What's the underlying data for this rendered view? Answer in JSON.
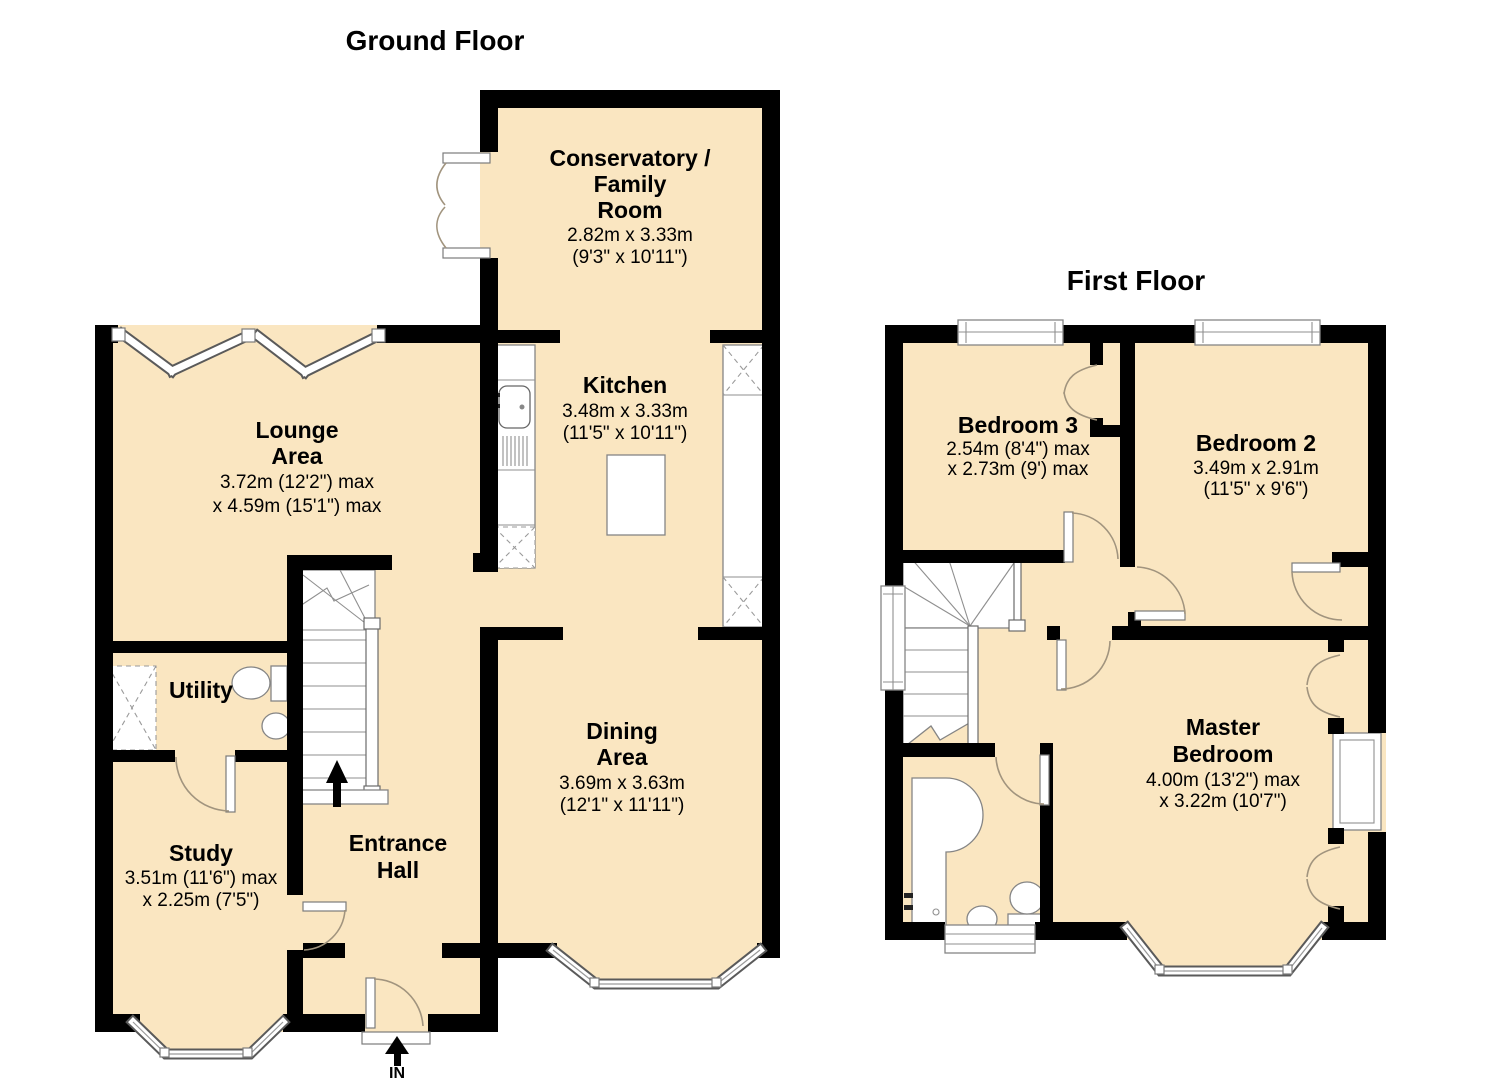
{
  "titles": {
    "ground": "Ground Floor",
    "first": "First Floor"
  },
  "entry_label": "IN",
  "ground": {
    "conservatory": {
      "lines": [
        "Conservatory /",
        "Family",
        "Room"
      ],
      "dims": [
        "2.82m x 3.33m",
        "(9'3\" x 10'11\")"
      ]
    },
    "kitchen": {
      "lines": [
        "Kitchen"
      ],
      "dims": [
        "3.48m x 3.33m",
        "(11'5\" x 10'11\")"
      ]
    },
    "lounge": {
      "lines": [
        "Lounge",
        "Area"
      ],
      "dims": [
        "3.72m (12'2\") max",
        "x 4.59m (15'1\") max"
      ]
    },
    "utility": {
      "lines": [
        "Utility"
      ],
      "dims": []
    },
    "entrance": {
      "lines": [
        "Entrance",
        "Hall"
      ],
      "dims": []
    },
    "study": {
      "lines": [
        "Study"
      ],
      "dims": [
        "3.51m (11'6\") max",
        "x 2.25m (7'5\")"
      ]
    },
    "dining": {
      "lines": [
        "Dining",
        "Area"
      ],
      "dims": [
        "3.69m x 3.63m",
        "(12'1\" x 11'11\")"
      ]
    }
  },
  "first": {
    "bedroom3": {
      "lines": [
        "Bedroom 3"
      ],
      "dims": [
        "2.54m (8'4\") max",
        "x 2.73m (9') max"
      ]
    },
    "bedroom2": {
      "lines": [
        "Bedroom 2"
      ],
      "dims": [
        "3.49m x 2.91m",
        "(11'5\" x 9'6\")"
      ]
    },
    "master": {
      "lines": [
        "Master",
        "Bedroom"
      ],
      "dims": [
        "4.00m (13'2\") max",
        "x 3.22m (10'7\")"
      ]
    }
  },
  "colors": {
    "room_fill": "#fae6c1",
    "wall": "#000000",
    "fixture_line": "#858585",
    "door_arc": "#a1947e"
  }
}
